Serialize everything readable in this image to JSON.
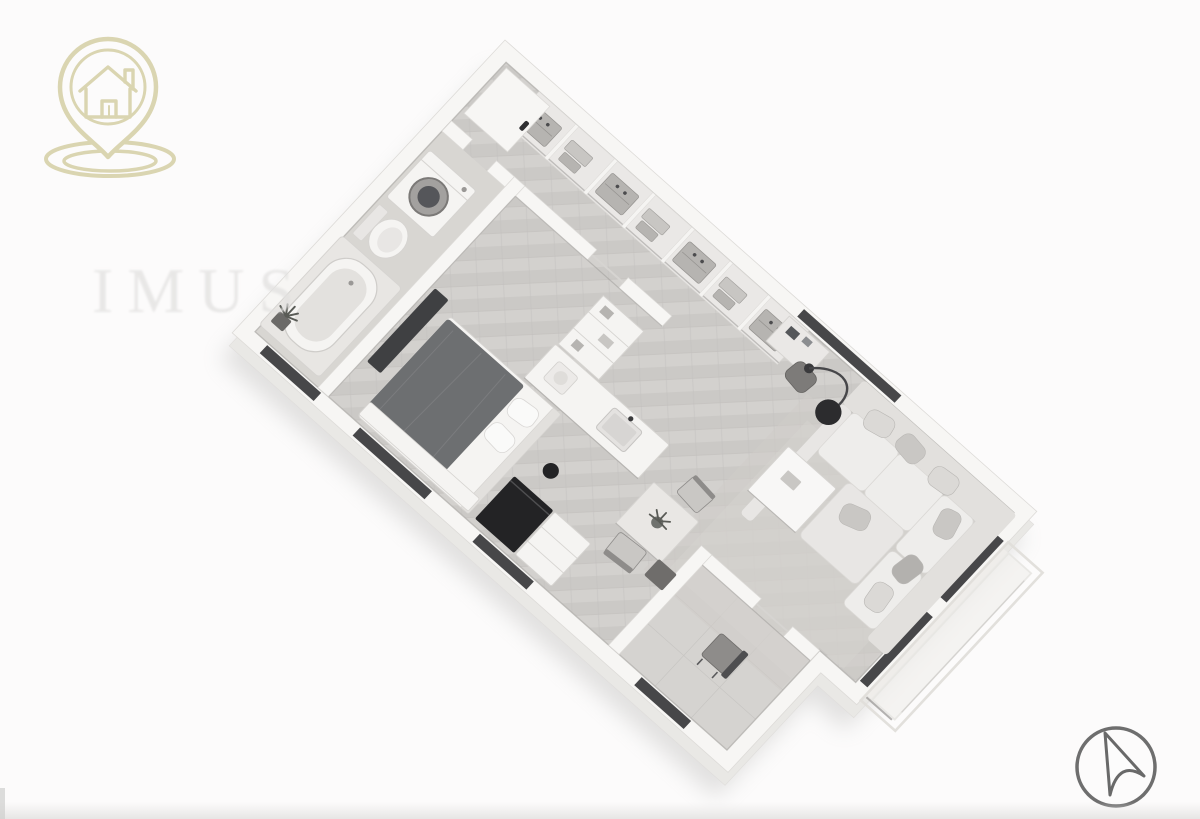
{
  "page": {
    "background": "#fcfbfb"
  },
  "branding": {
    "logo_icon": "house-location-pin-icon"
  },
  "view_controls": {
    "compass_icon": "north-arrow-icon"
  },
  "watermark": {
    "text": "IMUS"
  },
  "floorplan": {
    "view": "isometric-3d-apartment-floor-plan-render",
    "rooms": [
      {
        "name": "bathroom",
        "furniture": [
          "washing-machine",
          "toilet",
          "bathtub",
          "plant"
        ]
      },
      {
        "name": "bedroom",
        "furniture": [
          "double-bed",
          "pillows",
          "dark-dresser",
          "foot-bench"
        ]
      },
      {
        "name": "wardrobe-hallway",
        "furniture": [
          "wardrobe-compartments",
          "tall-door-panel"
        ]
      },
      {
        "name": "kitchen",
        "furniture": [
          "counter-with-sink",
          "tall-cabinet",
          "dark-island-cabinet",
          "cart",
          "stool"
        ]
      },
      {
        "name": "dining-area",
        "furniture": [
          "square-table",
          "plant",
          "chairs"
        ]
      },
      {
        "name": "living-room",
        "furniture": [
          "corner-sofa",
          "pillows",
          "ottoman",
          "coffee-table",
          "arc-floor-lamp",
          "desk",
          "desk-chair",
          "rug"
        ]
      },
      {
        "name": "entry-hall",
        "furniture": [
          "chair",
          "side-table"
        ]
      },
      {
        "name": "balcony",
        "furniture": [
          "railing"
        ]
      }
    ]
  },
  "colors": {
    "bg": "#fcfbfb",
    "logo_gold": "#d8d2ab",
    "compass_gray": "#6e6e6e",
    "wall": "#f7f6f4",
    "wall_edge": "#dddbd8",
    "wall_line": "#9d9b98",
    "extrude": "#e9e8e5",
    "shadow": "#a9a8a6",
    "floor_a": "#d3d1ce",
    "floor_b": "#cbc9c6",
    "floor_line": "#c2c0bd",
    "bath_floor": "#d8d6d2",
    "vestibule_floor": "#d5d3d0",
    "rug": "#cfccc8",
    "rug_inner": "#d6d4d0",
    "sofa": "#e8e6e4",
    "sofa_back": "#e2e0dd",
    "cushion": "#eeedeb",
    "pillow_light": "#dbd9d6",
    "pillow_mid": "#c9c7c4",
    "pillow_dark": "#b3b1ae",
    "duvet": "#6d6f71",
    "dark_wood": "#3f4042",
    "near_black": "#232325",
    "window_dark": "#2f2f31",
    "white_furn": "#f5f4f2",
    "furn_edge": "#d6d4d1",
    "table_top": "#e9e7e4",
    "metal": "#8e8c8a",
    "plant": "#595b56",
    "watermark": "#e2e1e0",
    "wardrobe_base": "#eae8e6",
    "item_a": "#b6b4b1",
    "item_b": "#c8c6c3"
  }
}
